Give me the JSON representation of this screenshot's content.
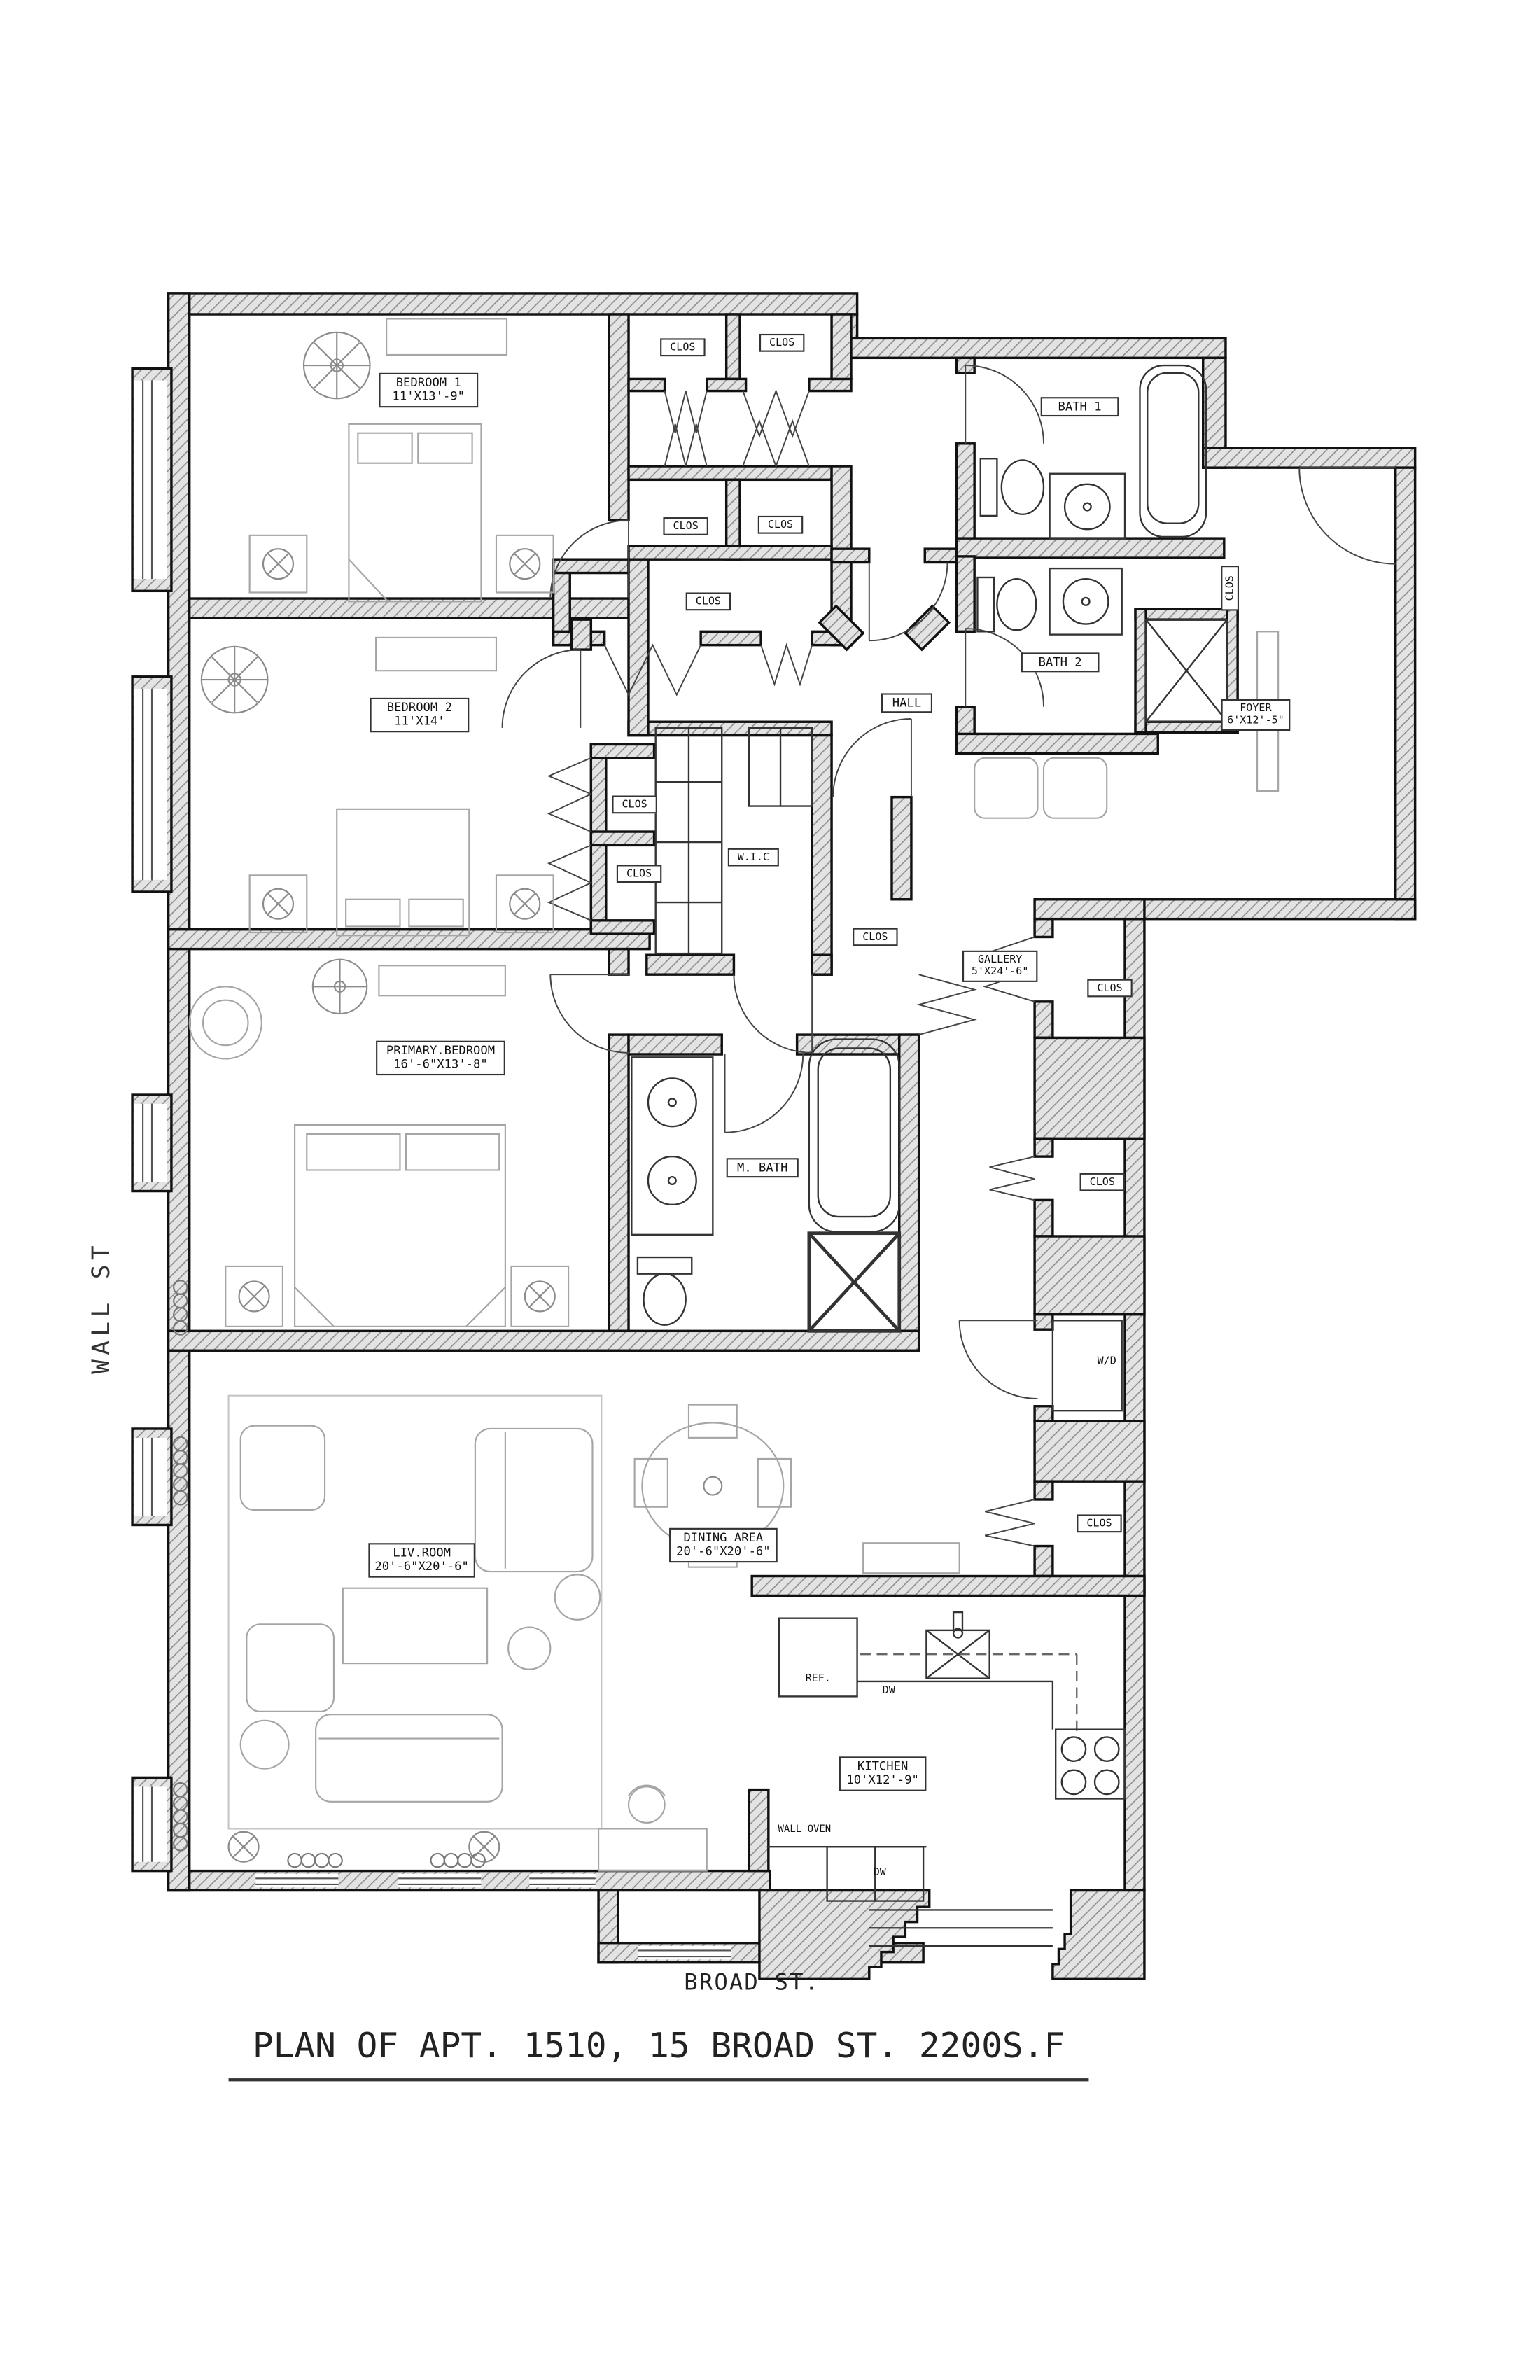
{
  "title": {
    "text": "PLAN OF APT. 1510, 15 BROAD ST. 2200S.F"
  },
  "streets": {
    "wall_st": "WALL ST",
    "broad_st": "BROAD ST."
  },
  "rooms": {
    "bedroom1": {
      "name": "BEDROOM 1",
      "dims": "11'X13'-9\""
    },
    "bedroom2": {
      "name": "BEDROOM 2",
      "dims": "11'X14'"
    },
    "primary_bedroom": {
      "name": "PRIMARY.BEDROOM",
      "dims": "16'-6\"X13'-8\""
    },
    "bath1": {
      "name": "BATH 1"
    },
    "bath2": {
      "name": "BATH 2"
    },
    "m_bath": {
      "name": "M. BATH"
    },
    "wic": {
      "name": "W.I.C"
    },
    "hall": {
      "name": "HALL"
    },
    "foyer": {
      "name": "FOYER",
      "dims": "6'X12'-5\""
    },
    "gallery": {
      "name": "GALLERY",
      "dims": "5'X24'-6\""
    },
    "living_room": {
      "name": "LIV.ROOM",
      "dims": "20'-6\"X20'-6\""
    },
    "dining_area": {
      "name": "DINING AREA",
      "dims": "20'-6\"X20'-6\""
    },
    "kitchen": {
      "name": "KITCHEN",
      "dims": "10'X12'-9\""
    }
  },
  "labels": {
    "closet": "CLOS",
    "washer_dryer": "W/D",
    "refrigerator": "REF.",
    "dishwasher": "DW",
    "wall_oven": "WALL OVEN"
  }
}
